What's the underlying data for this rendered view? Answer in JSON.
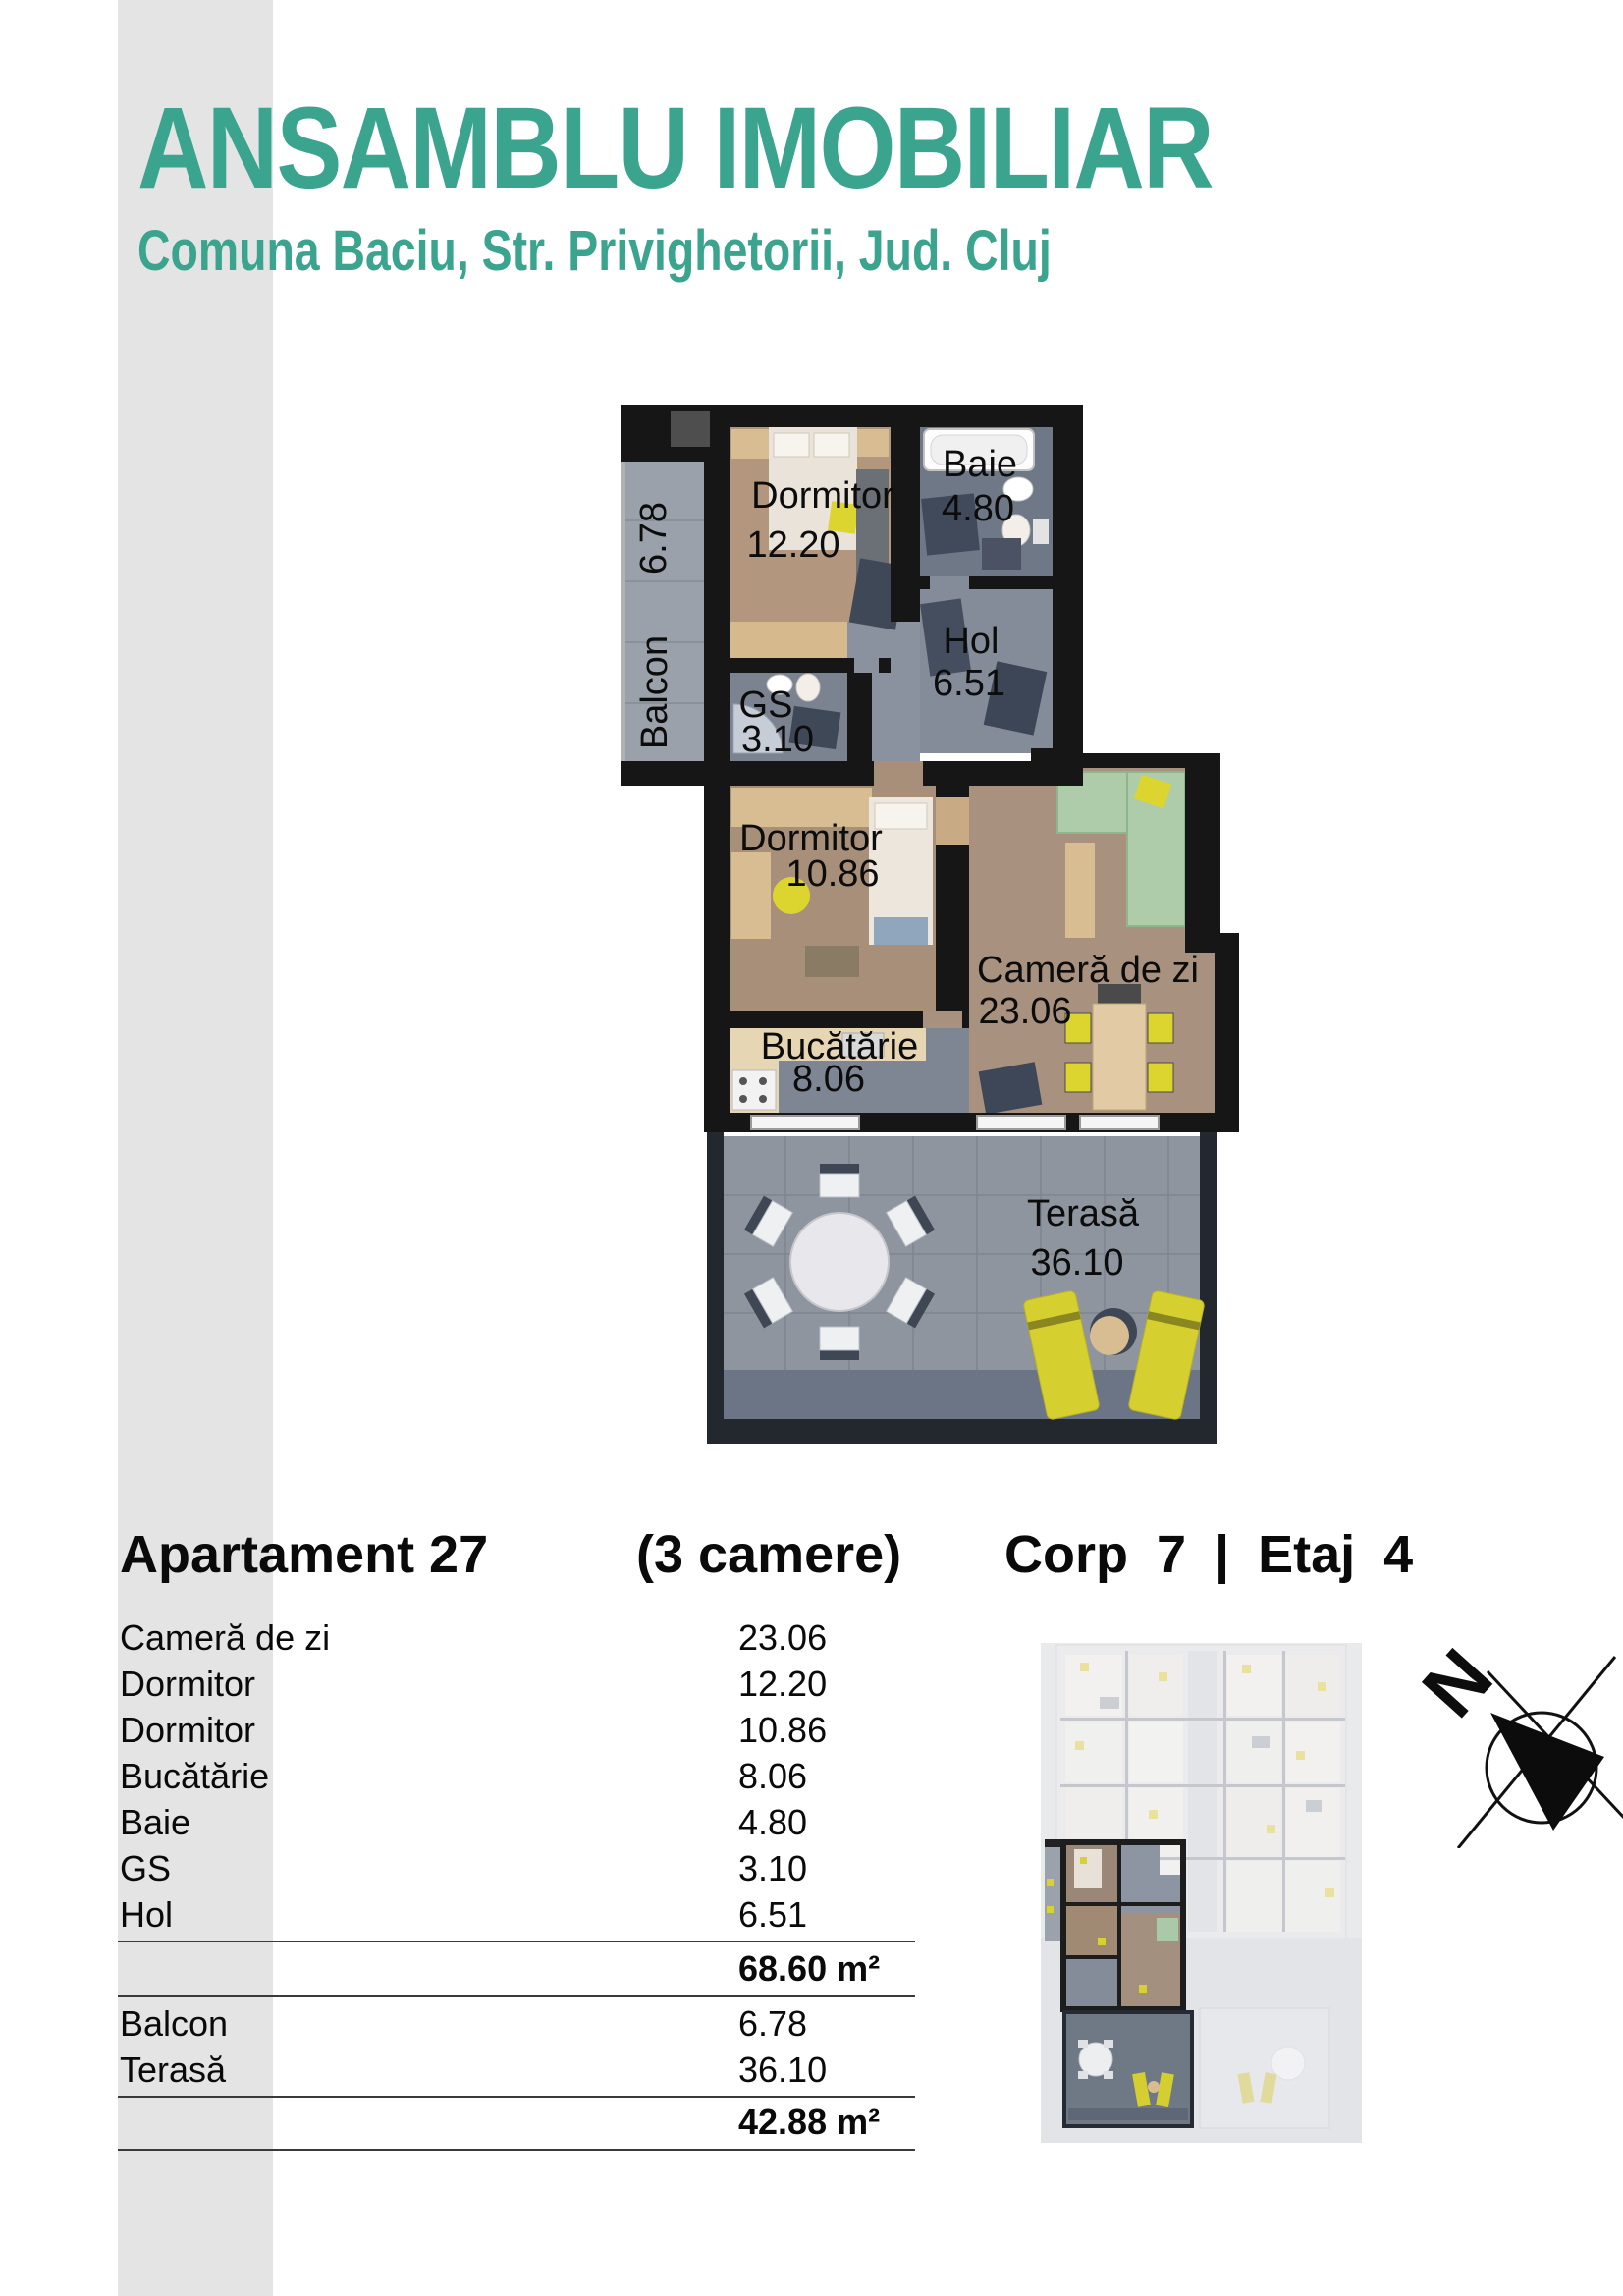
{
  "header": {
    "title": "ANSAMBLU IMOBILIAR",
    "subtitle": "Comuna Baciu, Str. Privighetorii, Jud. Cluj"
  },
  "colors": {
    "accent": "#3aa48e",
    "wall": "#161616",
    "yellow_accent": "#d8d22f",
    "terrace_floor": "#8e959f",
    "wood_floor": "#ab9178"
  },
  "plan": {
    "rooms": [
      {
        "name": "Dormitor",
        "area": "12.20"
      },
      {
        "name": "Baie",
        "area": "4.80"
      },
      {
        "name": "Hol",
        "area": "6.51"
      },
      {
        "name": "GS",
        "area": "3.10"
      },
      {
        "name": "Dormitor",
        "area": "10.86"
      },
      {
        "name": "Cameră de zi",
        "area": "23.06"
      },
      {
        "name": "Bucătărie",
        "area": "8.06"
      },
      {
        "name": "Balcon",
        "area": "6.78"
      },
      {
        "name": "Terasă",
        "area": "36.10"
      }
    ]
  },
  "listing": {
    "apartment": "Apartament 27",
    "rooms_note": "(3 camere)",
    "corp_etaj": "Corp 7 | Etaj 4"
  },
  "table": {
    "rows": [
      {
        "label": "Cameră de zi",
        "value": "23.06"
      },
      {
        "label": "Dormitor",
        "value": "12.20"
      },
      {
        "label": "Dormitor",
        "value": "10.86"
      },
      {
        "label": "Bucătărie",
        "value": "8.06"
      },
      {
        "label": "Baie",
        "value": "4.80"
      },
      {
        "label": "GS",
        "value": "3.10"
      },
      {
        "label": "Hol",
        "value": "6.51"
      }
    ],
    "interior_total": "68.60 m²",
    "annex_rows": [
      {
        "label": "Balcon",
        "value": "6.78"
      },
      {
        "label": "Terasă",
        "value": "36.10"
      }
    ],
    "annex_total": "42.88 m²"
  },
  "compass": {
    "north_label": "N"
  }
}
